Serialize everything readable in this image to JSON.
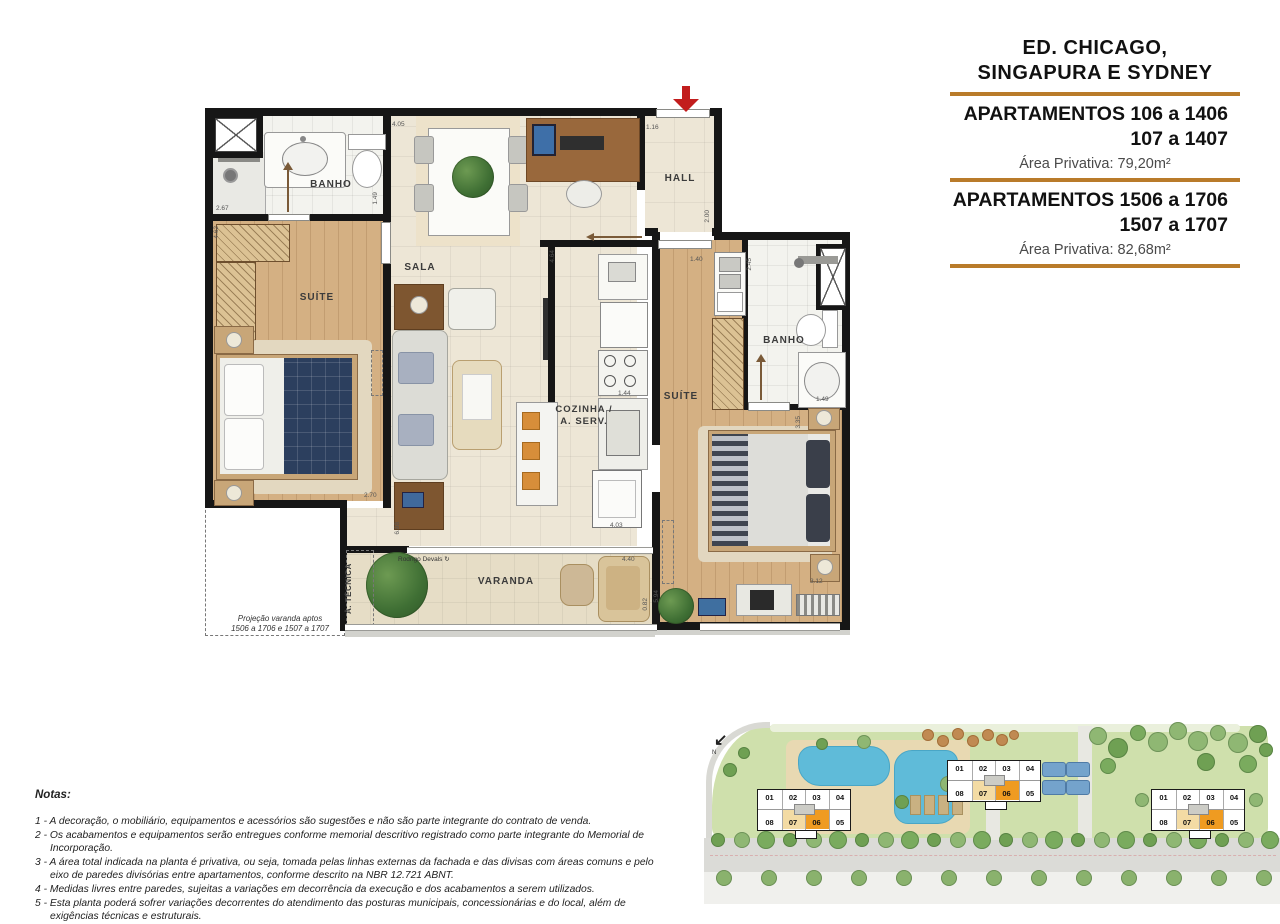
{
  "title_block": {
    "building_line1": "ED. CHICAGO,",
    "building_line2": "SINGAPURA E SYDNEY",
    "rule_color": "#B97B2A",
    "apartments": [
      {
        "line1": "APARTAMENTOS 106 a 1406",
        "line2": "107 a 1407",
        "area": "Área Privativa: 79,20m²"
      },
      {
        "line1": "APARTAMENTOS 1506 a 1706",
        "line2": "1507 a 1707",
        "area": "Área Privativa: 82,68m²"
      }
    ]
  },
  "floor_plan": {
    "rooms": {
      "banho1": "BANHO",
      "suite1": "SUÍTE",
      "sala": "SALA",
      "hall": "HALL",
      "cozinha_line1": "COZINHA /",
      "cozinha_line2": "A. SERV.",
      "suite2": "SUÍTE",
      "banho2": "BANHO",
      "varanda": "VARANDA",
      "area_tecnica": "Á. TÉCNICA"
    },
    "dimensions": {
      "d405": "4.05",
      "d116": "1.16",
      "d267": "2.67",
      "d149a": "1.49",
      "d462": "4.62",
      "d270": "2.70",
      "d698": "6.98",
      "d464": "4.64",
      "d200": "2.00",
      "d140": "1.40",
      "d245": "2.45",
      "d144": "1.44",
      "d403": "4.03",
      "d440": "4.40",
      "d149b": "1.49",
      "d335": "3.35",
      "d312": "3.12",
      "d594": "5.94",
      "d082": "0.82"
    },
    "projection_note_line1": "Projeção varanda aptos",
    "projection_note_line2": "1506 a 1706 e 1507 a 1707",
    "signature": "Rodrigo Devals"
  },
  "notes": {
    "heading": "Notas:",
    "items": [
      "1 - A decoração, o mobiliário, equipamentos e acessórios são sugestões e não são parte integrante do contrato de venda.",
      "2 - Os acabamentos e equipamentos serão entregues conforme memorial descritivo registrado como parte integrante do Memorial de Incorporação.",
      "3 - A área total indicada na planta é privativa, ou seja, tomada pelas linhas externas da fachada e das divisas com áreas comuns e pelo\neixo de paredes divisórias entre apartamentos, conforme descrito na NBR 12.721 ABNT.",
      "4 - Medidas livres entre paredes, sujeitas a variações em decorrência da execução e dos acabamentos a serem utilizados.",
      "5 - Esta planta poderá sofrer variações decorrentes do atendimento das posturas municipais, concessionárias e do local, além de\nexigências técnicas e estruturais."
    ]
  },
  "site_plan": {
    "north_label": "N",
    "buildings": [
      {
        "top_row": [
          "01",
          "02",
          "03",
          "04"
        ],
        "bottom_row": [
          "08",
          "07",
          "06",
          "05"
        ]
      },
      {
        "top_row": [
          "01",
          "02",
          "03",
          "04"
        ],
        "bottom_row": [
          "08",
          "07",
          "06",
          "05"
        ]
      },
      {
        "top_row": [
          "01",
          "02",
          "03",
          "04"
        ],
        "bottom_row": [
          "08",
          "07",
          "06",
          "05"
        ]
      }
    ],
    "highlight": {
      "tan_unit": "07",
      "tan_color": "#F3DBA4",
      "orange_unit": "06",
      "orange_color": "#EF9B21"
    }
  }
}
